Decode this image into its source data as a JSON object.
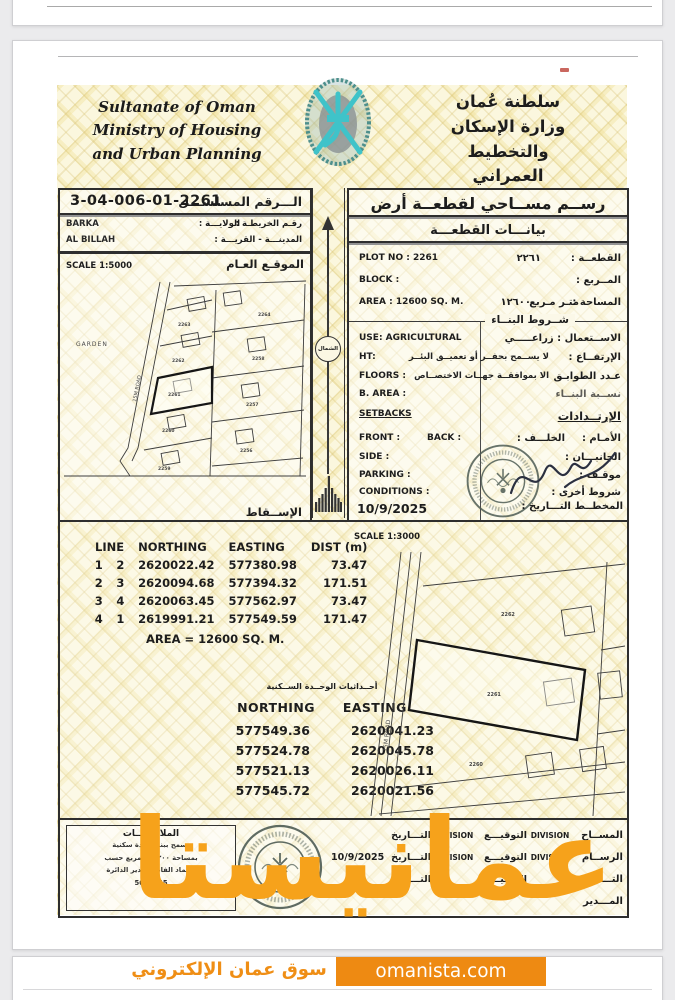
{
  "colors": {
    "watermark_orange": "#F6A21B",
    "badge_orange": "#EE8A12",
    "emblem_teal": "#3FC3C9",
    "stamp_green": "#4E5C54",
    "paper_yellow": "#FBF7DE"
  },
  "header": {
    "en": [
      "Sultanate of Oman",
      "Ministry of Housing",
      "and Urban Planning"
    ],
    "ar": [
      "سلطنة عُمان",
      "وزارة الإسكان",
      "والتخطيط العمراني"
    ]
  },
  "left_panel": {
    "serial_label": "الـــرقم المسلســـل",
    "serial_value": "3-04-006-01-2261",
    "map_no_label": "رقـم الخريطـة :",
    "wilaya_label": "الولايـــة :",
    "wilaya_value": "BARKA",
    "town_label": "المدينـــة - القريـــة :",
    "town_value": "AL BILLAH",
    "scale": "SCALE 1:5000",
    "site_plan_label": "الموقـع العـام",
    "projection_label": "الإســقاط",
    "north_label": "الشمال"
  },
  "maps": {
    "left": {
      "garden": "GARDEN",
      "road": "15M ROAD",
      "plots": [
        "2263",
        "2262",
        "2261",
        "2260",
        "2259",
        "2264",
        "2258",
        "2257",
        "2256"
      ]
    },
    "survey": {
      "scale": "SCALE 1:3000",
      "road": "15M ROAD",
      "plot_above": "2262",
      "plot_main": "2261",
      "plot_below": "2260"
    }
  },
  "right_panel": {
    "title": "رســم مســاحي لقطعــة أرض",
    "subtitle": "بيانـــات القطعـــة",
    "plot_no_en": "PLOT NO : 2261",
    "plot_value_ar": "٢٢٦١",
    "plot_label_ar": "القطعــة :",
    "block_en": "BLOCK :",
    "block_label_ar": "المــربع :",
    "area_en": "AREA :  12600 SQ. M.",
    "area_value_ar": "١٢٦٠٠",
    "area_unit_ar": "متـر مـربع",
    "area_label_ar": "المساحة :",
    "building_terms": "شــروط البنــاء",
    "use_en": "USE:   AGRICULTURAL",
    "use_label_ar": "الاســتعمال :  زراعـــــي",
    "ht_en": "HT:",
    "ht_note_ar": "لا يســمح بحفــر أو تعميــق البئــر",
    "ht_label_ar": "الإرتفــاع :",
    "floors_en": "FLOORS :",
    "floors_note_ar": "الا بموافقــة جهــات الاختصــاص",
    "floors_label_ar": "عـدد الطوابـق",
    "barea_en": "B. AREA :",
    "barea_label_ar": "نســبة البنــاء",
    "setbacks_en": "SETBACKS",
    "setbacks_label_ar": "الإرتــدادات",
    "front_en": "FRONT :",
    "back_en": "BACK :",
    "back_label_ar": "الخلـــف :",
    "front_label_ar": "الأمـام :",
    "side_en": "SIDE :",
    "side_label_ar": "الجانبـــان :",
    "parking_en": "PARKING :",
    "parking_label_ar": "موقـف :",
    "conditions_en": "CONDITIONS :",
    "conditions_label_ar": "شروط أخرى :",
    "date_value": "10/9/2025",
    "date_label_ar": "التـــاريخ :",
    "planner_label_ar": "المخطــط :"
  },
  "survey_tables": {
    "line_table": {
      "headers": [
        "LINE",
        "NORTHING",
        "EASTING",
        "DIST (m)"
      ],
      "rows": [
        [
          "1",
          "2",
          "2620022.42",
          "577380.98",
          "73.47"
        ],
        [
          "2",
          "3",
          "2620094.68",
          "577394.32",
          "171.51"
        ],
        [
          "3",
          "4",
          "2620063.45",
          "577562.97",
          "73.47"
        ],
        [
          "4",
          "1",
          "2619991.21",
          "577549.59",
          "171.47"
        ]
      ],
      "area_line": "AREA = 12600 SQ. M."
    },
    "unit_table": {
      "title_ar": "أحــداثيات الوحــدة الســكنية",
      "headers": [
        "NORTHING",
        "EASTING"
      ],
      "rows": [
        [
          "577549.36",
          "2620041.23"
        ],
        [
          "577524.78",
          "2620045.78"
        ],
        [
          "577521.13",
          "2620026.11"
        ],
        [
          "577545.72",
          "2620021.56"
        ]
      ]
    }
  },
  "footer": {
    "sign_rows": [
      {
        "role": "المســاح",
        "div1": "DIVISION",
        "sign": "التوقيـــع",
        "div2": "DIVISION",
        "date": "التـــاريخ",
        "value": ""
      },
      {
        "role": "الرســام",
        "div1": "DIVISION",
        "sign": "التوقيـــع",
        "div2": "DIVISION",
        "date": "التـــاريخ",
        "value": "10/9/2025"
      },
      {
        "role": "التـــدقيق",
        "div1": "",
        "sign": "التوقيـــع",
        "div2": "",
        "date": "التـــاريخ",
        "value": ""
      },
      {
        "role": "المـــدير",
        "div1": "",
        "sign": "",
        "div2": "",
        "date": "",
        "value": ""
      }
    ],
    "notes_title": "الملاحظـــات",
    "notes_lines": [
      "يسمح ببناء وحدة سكنية",
      "بمساحة ٢٠٠ متر مربع حسب",
      "اعتماد الفاضل مدير الدائرة",
      "5640845"
    ]
  },
  "watermark": {
    "brand": "عمانيستا",
    "tagline": "سوق عمان الإلكتروني",
    "site": "omanista.com"
  }
}
